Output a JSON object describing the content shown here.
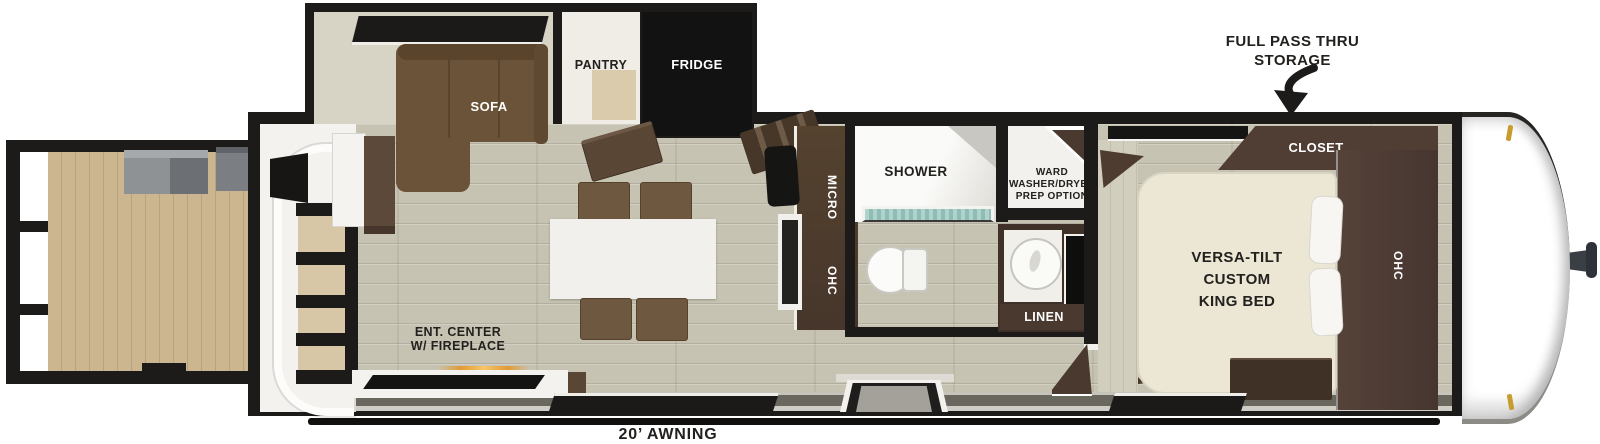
{
  "title": "Travel trailer floorplan",
  "colors": {
    "wall": "#1c1b19",
    "floor": "#c7c3b2",
    "deck_wood": "#ccb68f",
    "cabinet_dark": "#4d3b2e",
    "sofa_brown": "#6b5339",
    "bed_cream": "#ebe7d4",
    "accent_gold": "#c79d2d",
    "fireplace_glow": "#e39a33",
    "shower_glass": "#9cc7c0"
  },
  "annotations": {
    "storage": "FULL PASS THRU\nSTORAGE",
    "awning": "20’ AWNING"
  },
  "slide_out": {
    "sofa": "SOFA",
    "pantry": "PANTRY",
    "fridge": "FRIDGE"
  },
  "kitchen": {
    "micro": "MICRO",
    "ohc": "OHC"
  },
  "bathroom": {
    "shower": "SHOWER",
    "ward": "WARD\nWASHER/DRYER\nPREP OPTION",
    "linen": "LINEN"
  },
  "bedroom": {
    "closet": "CLOSET",
    "ohc": "OHC",
    "bed": "VERSA-TILT\nCUSTOM\nKING BED"
  },
  "living": {
    "ent_center": "ENT. CENTER\nW/ FIREPLACE"
  }
}
